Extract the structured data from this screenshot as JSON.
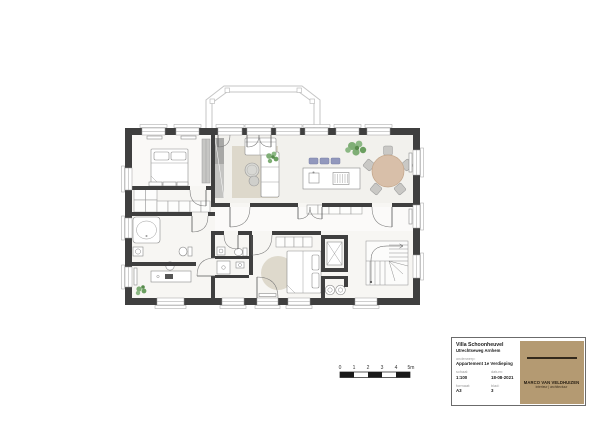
{
  "scale_bar": {
    "labels": [
      "0",
      "1",
      "2",
      "3",
      "4",
      "5m"
    ]
  },
  "title_block": {
    "project": "Villa Schoonheuvel",
    "address": "Utrechtseweg Arnhem",
    "subject_label": "onderwerp:",
    "subject": "Appartement 1e Verdieping",
    "scale_label": "schaal:",
    "scale": "1:100",
    "date_label": "datum:",
    "date": "18-08-2021",
    "format_label": "formaat:",
    "format": "A3",
    "sheet_label": "blad:",
    "sheet": "3",
    "firm_name": "MARCO VAN VELDHUIZEN",
    "firm_tagline": "interieur | architectuur"
  },
  "colors": {
    "wall": "#3f3f3f",
    "floor": "#f7f6f3",
    "living_floor": "#f2f1ed",
    "rug": "#ddd8cb",
    "dining_table": "#d8bfa9",
    "chair": "#c9c8c5",
    "kitchen_stool": "#9298bd",
    "plant": "#7fae76",
    "tall_cabinet": "#b3b3b1",
    "logo_background": "#b49a72",
    "scale_bar_black": "#1a1a1a"
  }
}
